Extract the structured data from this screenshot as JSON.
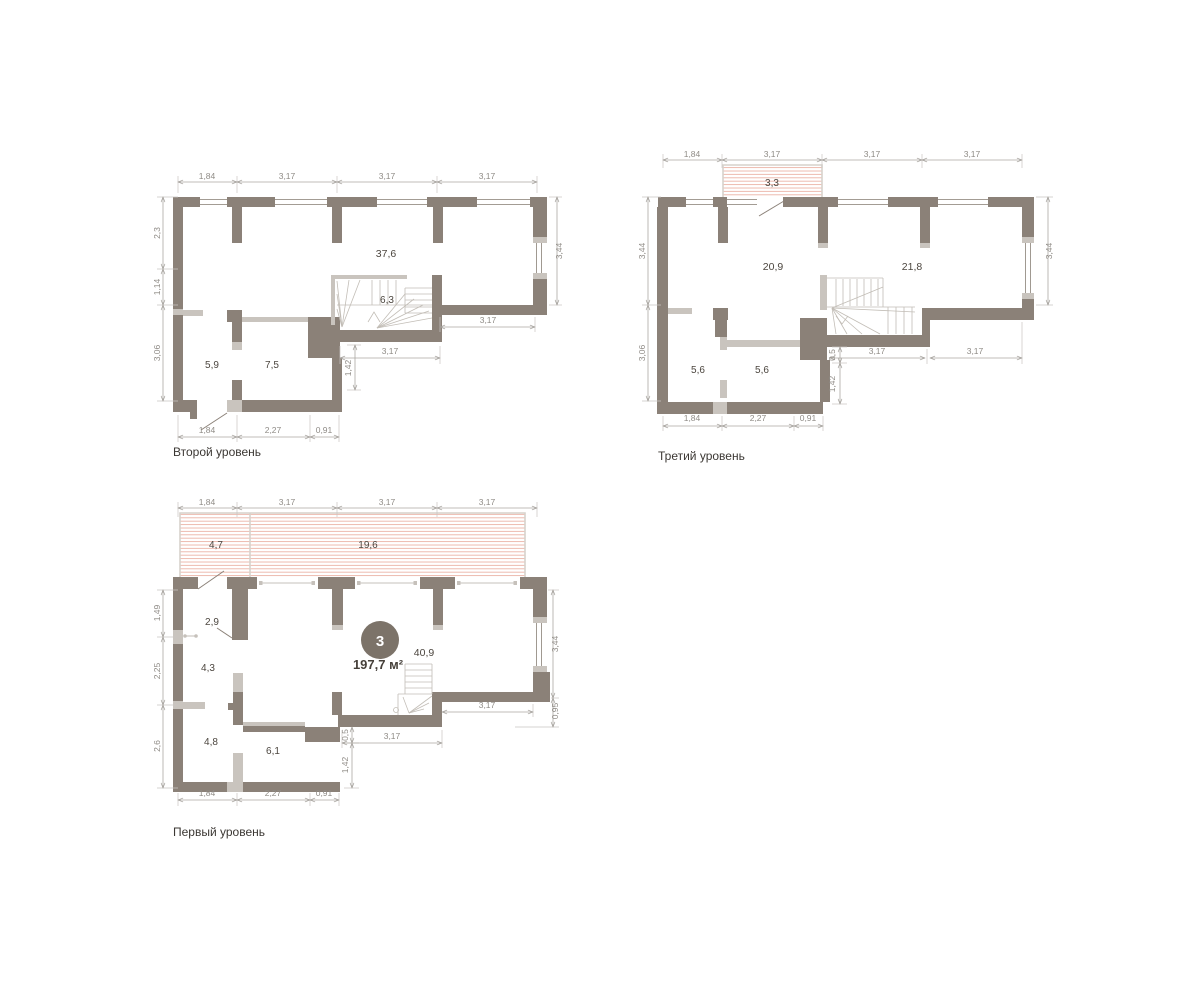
{
  "meta": {
    "width": 1200,
    "height": 988
  },
  "colors": {
    "background": "#ffffff",
    "wall_dark": "#8B8178",
    "wall_light": "#C9C4BE",
    "hatch_line": "#EBB4A8",
    "hatch_border": "#D7D2CC",
    "dim_line": "#ABA7A2",
    "dim_text": "#8F8B86",
    "room_text": "#4C463F",
    "title_text": "#3B3733",
    "badge_fill": "#7C7369",
    "badge_text": "#ffffff"
  },
  "plans": {
    "second": {
      "title": "Второй уровень",
      "rooms": {
        "living": "37,6",
        "stair": "6,3",
        "room_a": "5,9",
        "room_b": "7,5"
      },
      "dims": {
        "top": [
          "1,84",
          "3,17",
          "3,17",
          "3,17"
        ],
        "left": [
          "2,3",
          "1,14",
          "3,06"
        ],
        "right": [
          "3,44"
        ],
        "bottom": [
          "1,84",
          "2,27",
          "0,91"
        ],
        "inner_right": "3,17",
        "inner_stair": "3,17",
        "inner_v": "1,42"
      }
    },
    "third": {
      "title": "Третий уровень",
      "rooms": {
        "balcony": "3,3",
        "living": "20,9",
        "room_a": "21,8",
        "room_b": "5,6",
        "room_c": "5,6"
      },
      "dims": {
        "top": [
          "1,84",
          "3,17",
          "3,17",
          "3,17"
        ],
        "left": [
          "3,44",
          "3,06"
        ],
        "right": [
          "3,44"
        ],
        "bottom": [
          "1,84",
          "2,27",
          "0,91"
        ],
        "inner_right": "3,17",
        "inner_stair": "3,17",
        "inner_v0": "0,5",
        "inner_v": "1,42"
      }
    },
    "first": {
      "title": "Первый уровень",
      "badge": {
        "number": "3",
        "total_area": "197,7 м²"
      },
      "rooms": {
        "terrace_a": "4,7",
        "terrace_b": "19,6",
        "hall": "2,9",
        "room_a": "4,3",
        "living": "40,9",
        "room_b": "4,8",
        "room_c": "6,1"
      },
      "dims": {
        "top": [
          "1,84",
          "3,17",
          "3,17",
          "3,17"
        ],
        "left": [
          "1,49",
          "2,25",
          "2,6"
        ],
        "right": [
          "3,44",
          "0,95"
        ],
        "bottom": [
          "1,84",
          "2,27",
          "0,91"
        ],
        "inner_right": "3,17",
        "inner_stair": "3,17",
        "inner_v0": "0,5",
        "inner_v": "1,42"
      }
    }
  }
}
